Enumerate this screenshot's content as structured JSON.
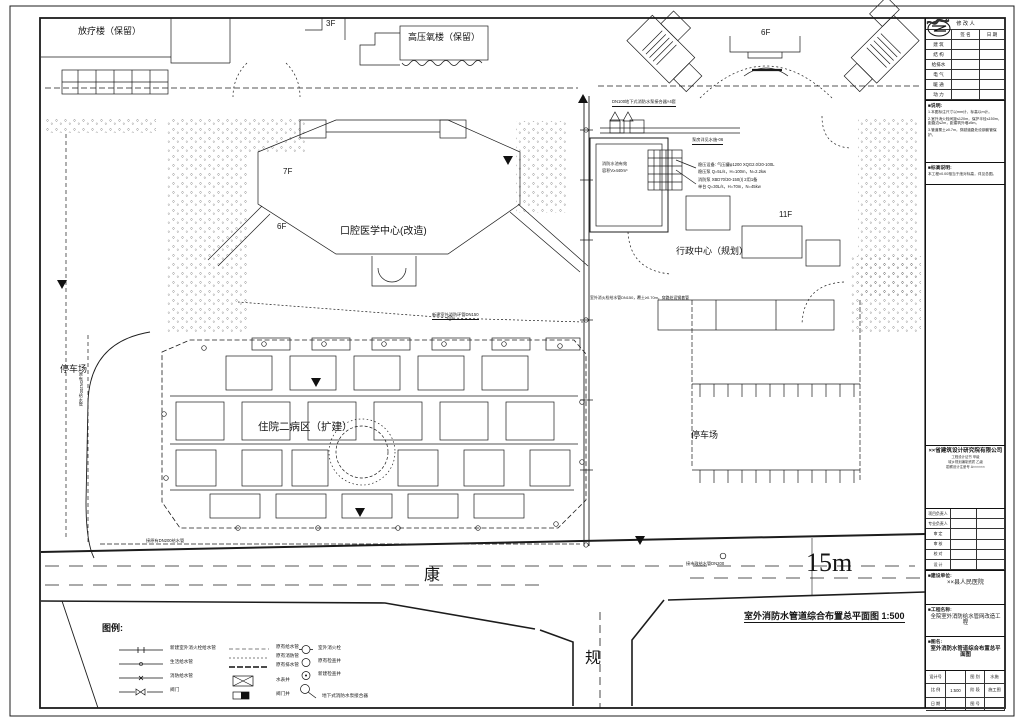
{
  "plan": {
    "labels": {
      "radiotherapy": "放疗楼（保留）",
      "f3": "3F",
      "hyperbaric": "高压氧楼（保留）",
      "f6_ne": "6F",
      "dental": "口腔医学中心(改造)",
      "f7": "7F",
      "f6_dental": "6F",
      "admin": "行政中心（规划）",
      "f11": "11F",
      "ward": "住院二病区（扩建）",
      "parking_west": "停车场",
      "parking_east": "停车场",
      "road_h": "康",
      "road_v": "规",
      "road_width": "15m"
    },
    "annotations": {
      "adapter": "DN100地下式消防水泵接合器×4套",
      "pump_room_ref": "泵房详见水施-06",
      "pool_l1": "消防水池有效",
      "pool_l2": "容积V≥440m³",
      "spec1": "稳压设备: 气压罐φ1200 XQG2.0/20-100L",
      "spec2": "稳压泵 Q=5L/s，H=100m，N=2.2kw",
      "spec3": "消防泵 XBD70/30-150(I) 2用1备",
      "spec4": "单台 Q=30L/s，H=70m，N=45kw",
      "long_spec": "室外消火栓给水管DN150，覆土≥0.70m，穿路处设钢套管",
      "hydrant_line": "新建室外消防环管DN150",
      "city_main": "接市政给水管DN200",
      "keep_main": "接原有DN200给水管",
      "west_pipe": "原有DN200给水管"
    },
    "drawing_title": "室外消防水管道综合布置总平面图 1:500"
  },
  "legend": {
    "title": "图例:",
    "col1": [
      "新建室外消火栓给水管",
      "生活给水管",
      "消防给水管",
      "阀门"
    ],
    "col2": [
      "原有给水管",
      "原有消防管",
      "原有排水管",
      "水表井",
      "阀门井"
    ],
    "col3": [
      "室外消火栓",
      "原有检查井",
      "新建检查井",
      "地下式消防水泵接合器"
    ]
  },
  "titleblock": {
    "rev_head": "修 改 人",
    "rev_sub1": "签 名",
    "rev_sub2": "日 期",
    "rev_rows": [
      "建 筑",
      "结 构",
      "给排水",
      "电 气",
      "暖 通",
      "动 力"
    ],
    "notes_title": "■说明:",
    "notes": [
      "1.本图标注尺寸以mm计，标高以m计。",
      "2.室外消火栓间距≤120m，保护半径≤150m，距路边≤2m，距建筑外墙≥5m。",
      "3.管道覆土≥0.7m，穿越道路处设钢套管保护。"
    ],
    "datum_title": "■标高说明:",
    "datum_text": "本工程±0.00相当于绝对标高，详见总图。",
    "company": {
      "name": "××省建筑设计研究院有限公司",
      "line1": "工程设计证书 甲级",
      "line2": "城乡规划编制资质 乙级",
      "line3": "勘察设计注册号 A××××××"
    },
    "sign_rows": [
      "项目负责人",
      "专业负责人",
      "审  定",
      "审  核",
      "校  对",
      "设  计"
    ],
    "owner_title": "■建设单位:",
    "owner": "××县人民医院",
    "project_title": "■工程名称:",
    "project": "全院室外消防给水管网改造工程",
    "sheet_title_label": "■图名:",
    "sheet_name": "室外消防水管道综合布置总平面图",
    "grid": {
      "c1l": "设计号",
      "c1v": "",
      "c2l": "图 别",
      "c2v": "水施",
      "c3l": "比 例",
      "c3v": "1:500",
      "c4l": "阶 段",
      "c4v": "施工图",
      "c5l": "日 期",
      "c5v": "",
      "c6l": "图 号",
      "c6v": ""
    }
  }
}
